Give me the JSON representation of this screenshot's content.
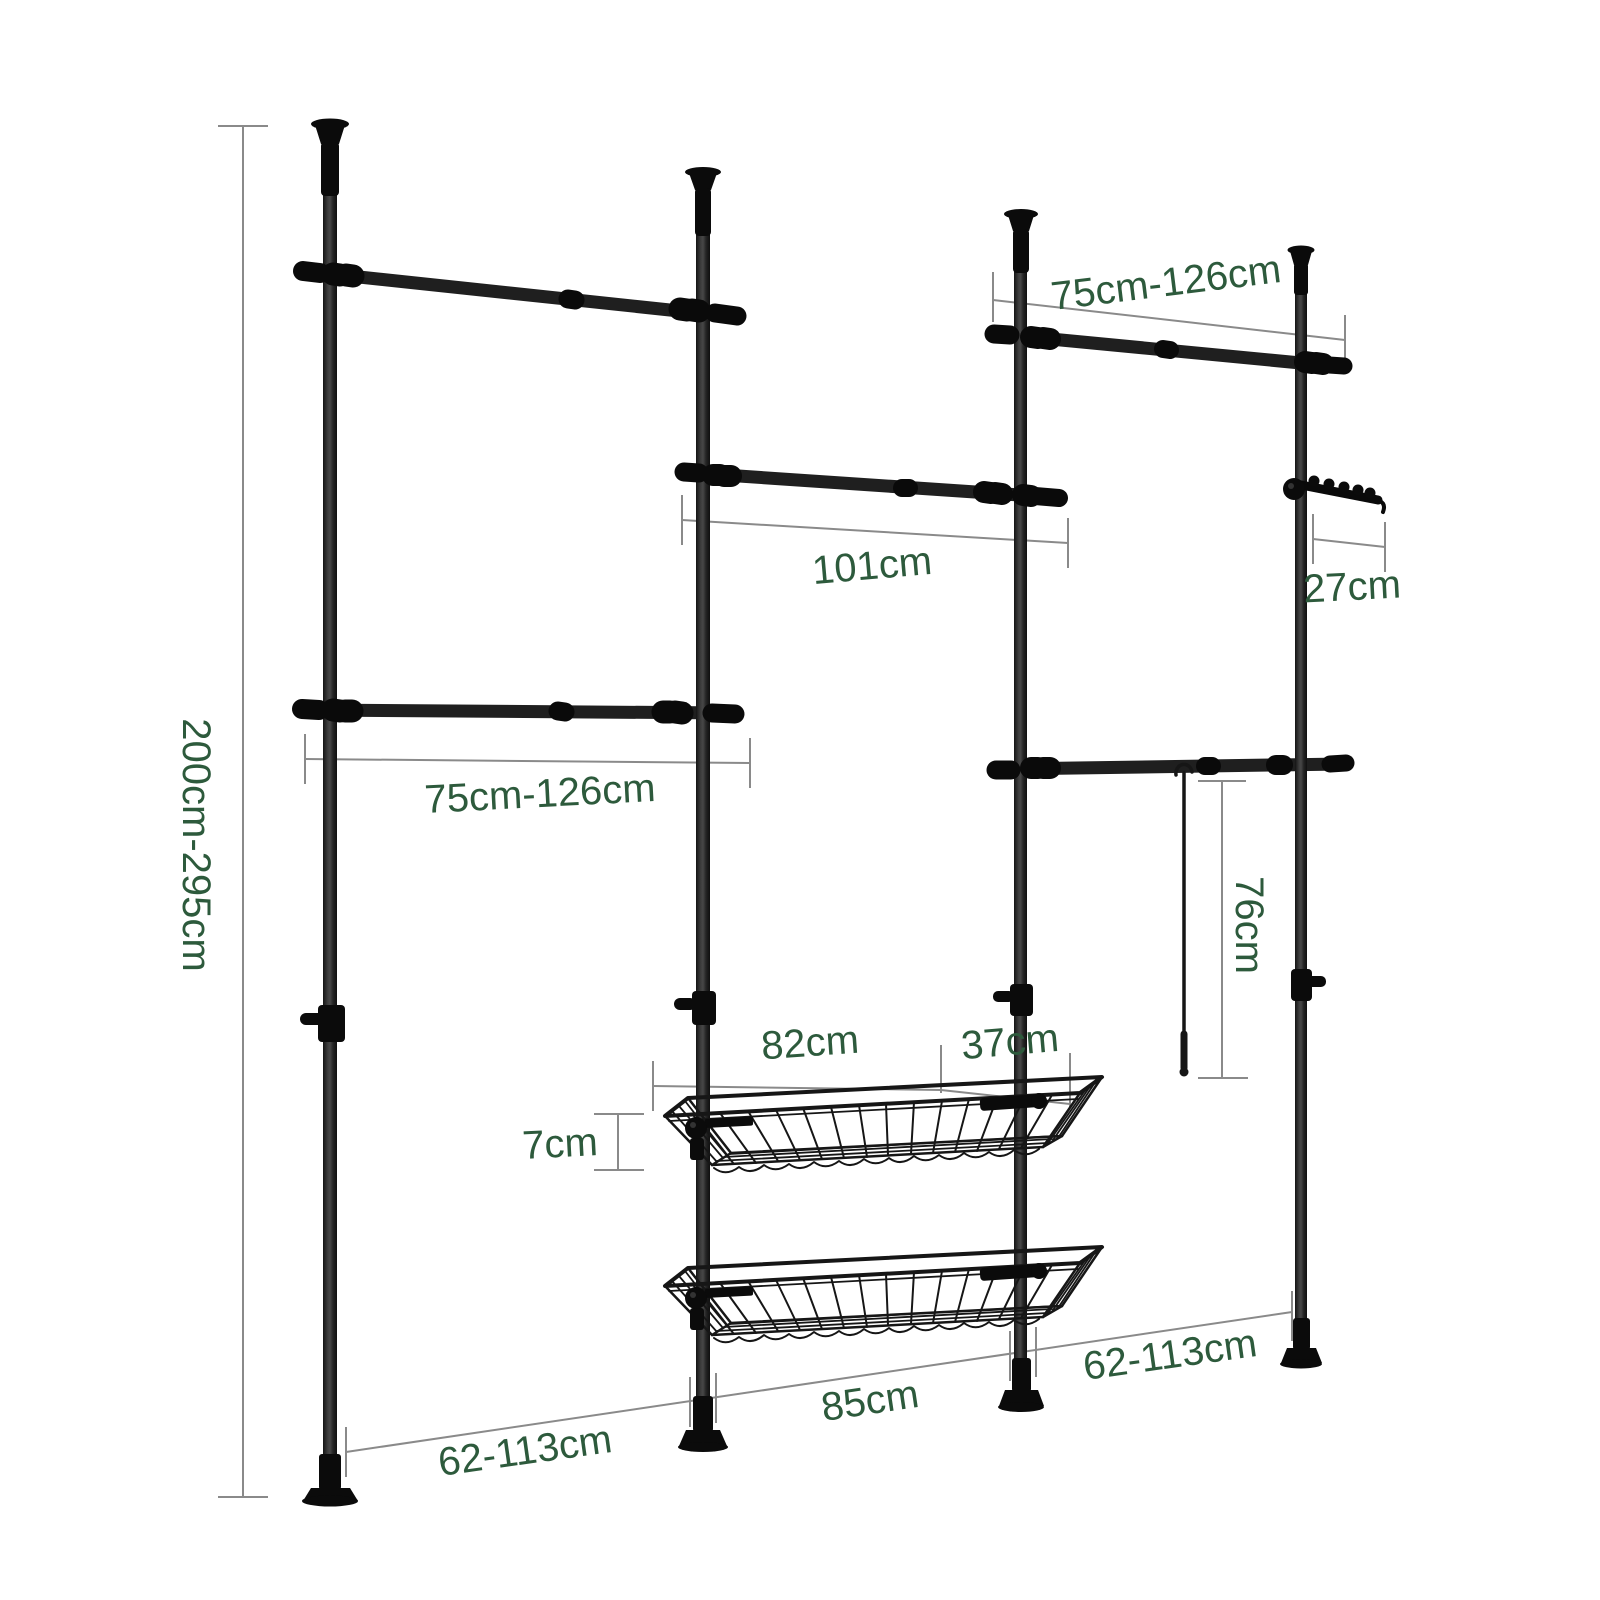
{
  "diagram": {
    "background": "#ffffff",
    "colors": {
      "dimension_text": "#2d5a3c",
      "dimension_line": "#8a8a8a",
      "product_frame": "#1b1b1b"
    },
    "dimensions": {
      "total_height": "200cm-295cm",
      "left_rail_length": "75cm-126cm",
      "right_rail_length": "75cm-126cm",
      "middle_rail_length": "101cm",
      "hook_rack_length": "27cm",
      "hanging_rod_length": "76cm",
      "basket_length": "82cm",
      "basket_depth": "37cm",
      "basket_rail_height": "7cm",
      "floor_span_left": "62-113cm",
      "floor_span_middle": "85cm",
      "floor_span_right": "62-113cm"
    }
  }
}
